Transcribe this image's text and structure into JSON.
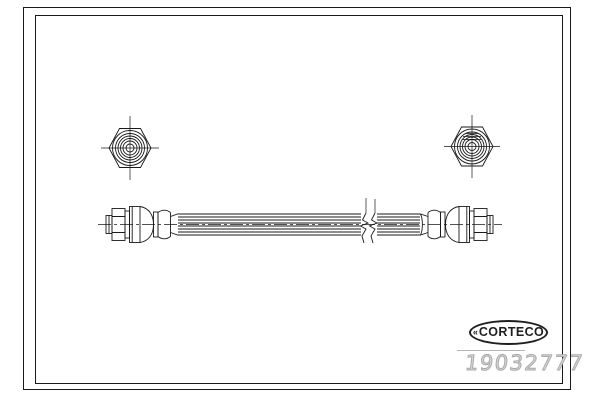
{
  "branding": {
    "logo_text": "CORTECO",
    "logo_mark": "«"
  },
  "product": {
    "part_number": "19032777"
  },
  "colors": {
    "line": "#1a1a1a",
    "background": "#ffffff",
    "part_number": "#a9a9a9",
    "divider": "#b5b5b5",
    "logo": "#1f1f1f"
  }
}
